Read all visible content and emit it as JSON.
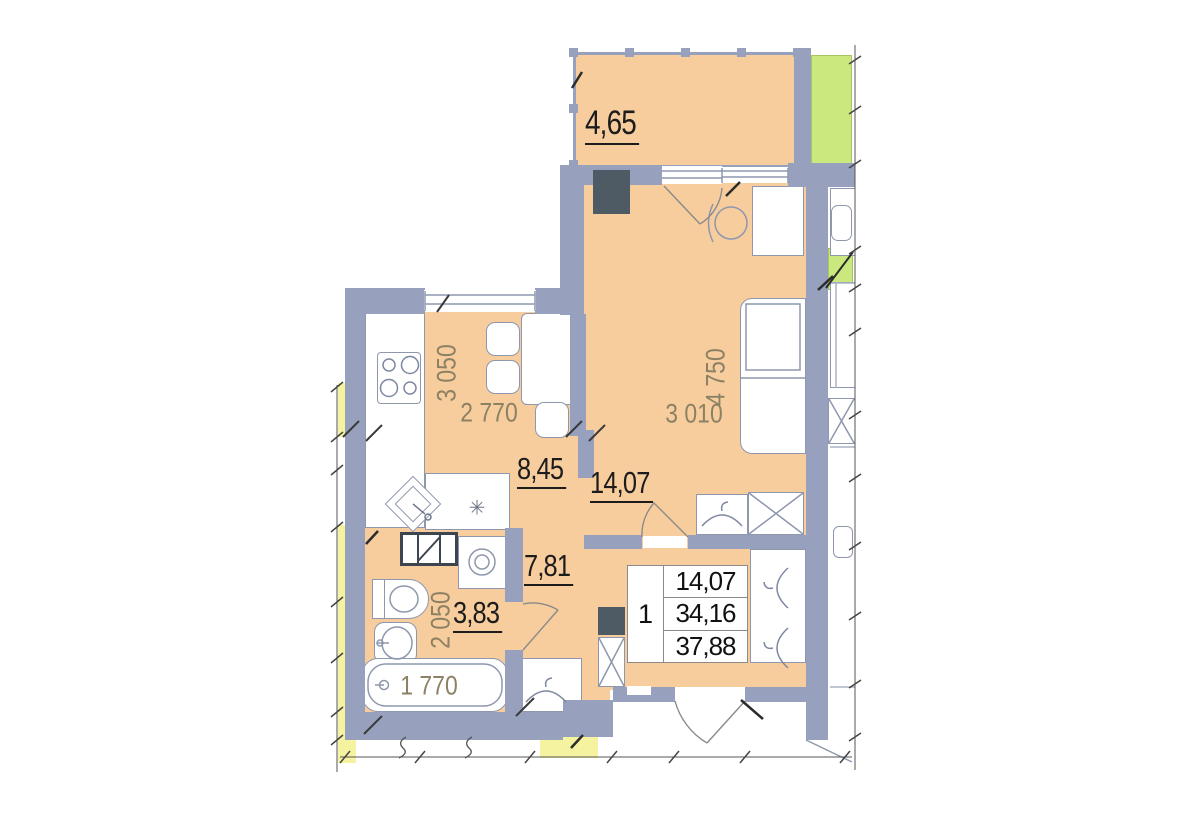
{
  "title": "apartment-floor-plan",
  "labels": {
    "balcony_area": "4,65",
    "kitchen_area": "8,45",
    "kitchen_width": "2 770",
    "kitchen_depth": "3 050",
    "room_area": "14,07",
    "room_width": "3 010",
    "room_depth": "4 750",
    "hall_area": "7,81",
    "bath_area": "3,83",
    "bath_depth": "2 050",
    "bathtub_length": "1 770"
  },
  "info_table": {
    "rooms": "1",
    "living_space": "14,07",
    "apartment_area": "34,16",
    "total_area": "37,88"
  },
  "symbols": {
    "washer_mark": "✳"
  },
  "colors": {
    "wall": "#97A1BE",
    "room": "#F7CD9E",
    "green": "#CBE87E",
    "yellow": "#F6F3A0",
    "shaft": "#4E5A64",
    "dim": "#8C8164",
    "label": "#1C1C1C",
    "furnline": "#8E97AD"
  }
}
